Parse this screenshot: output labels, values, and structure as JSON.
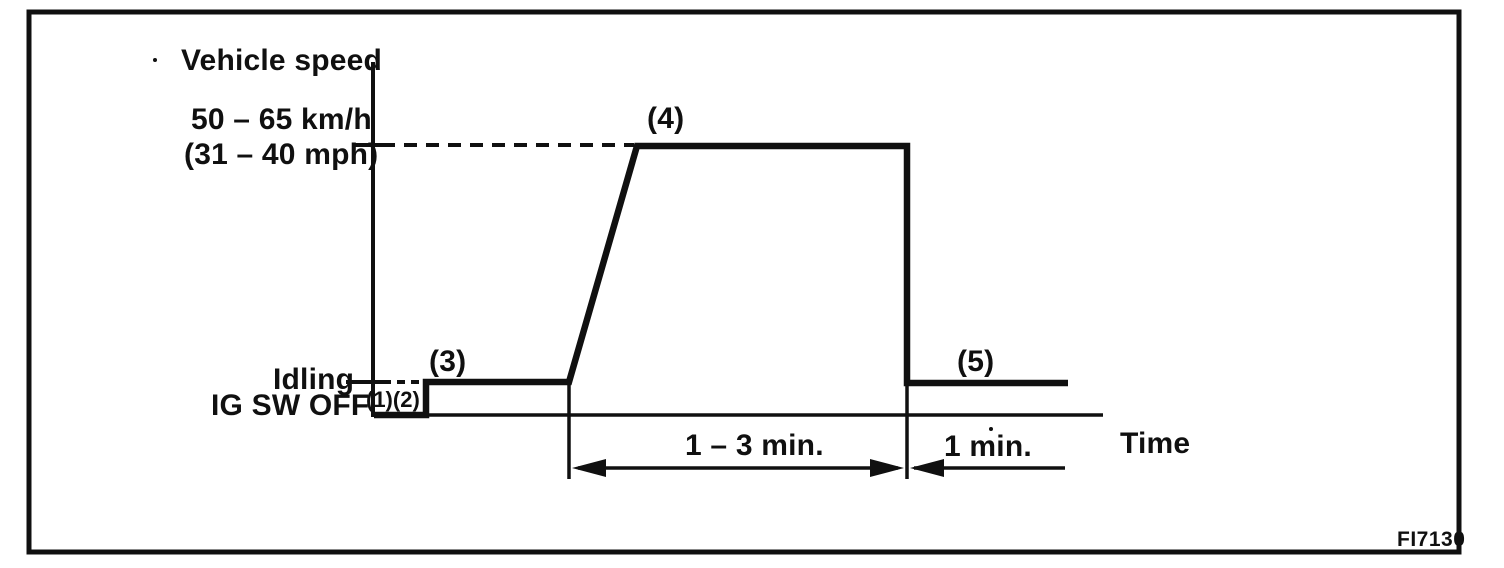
{
  "figure": {
    "code": "FI7130",
    "axes": {
      "y_label": "Vehicle speed",
      "x_label": "Time"
    },
    "y_levels": {
      "high_kmh": "50 – 65 km/h",
      "high_mph": "(31 – 40 mph)",
      "idling": "Idling",
      "ig_sw_off": "IG SW OFF"
    },
    "steps": {
      "s12": "(1)(2)",
      "s3": "(3)",
      "s4": "(4)",
      "s5": "(5)"
    },
    "durations": {
      "cruise": "1 – 3 min.",
      "final_idle": "1 min."
    },
    "colors": {
      "ink": "#101010",
      "paper": "#ffffff"
    }
  },
  "chart_data": {
    "type": "line",
    "title": "",
    "xlabel": "Time",
    "ylabel": "Vehicle speed",
    "y_tick_labels": [
      "IG SW OFF",
      "Idling",
      "50 – 65 km/h (31 – 40 mph)"
    ],
    "grid": false,
    "series": [
      {
        "name": "vehicle speed pattern",
        "points": [
          {
            "step": "(1)(2)",
            "level": "IG SW OFF"
          },
          {
            "step": "(3)",
            "level": "Idling"
          },
          {
            "step": "(4)",
            "level": "50 – 65 km/h (31 – 40 mph)",
            "duration": "1 – 3 min."
          },
          {
            "step": "(5)",
            "level": "Idling",
            "duration": "1 min."
          }
        ]
      }
    ]
  }
}
